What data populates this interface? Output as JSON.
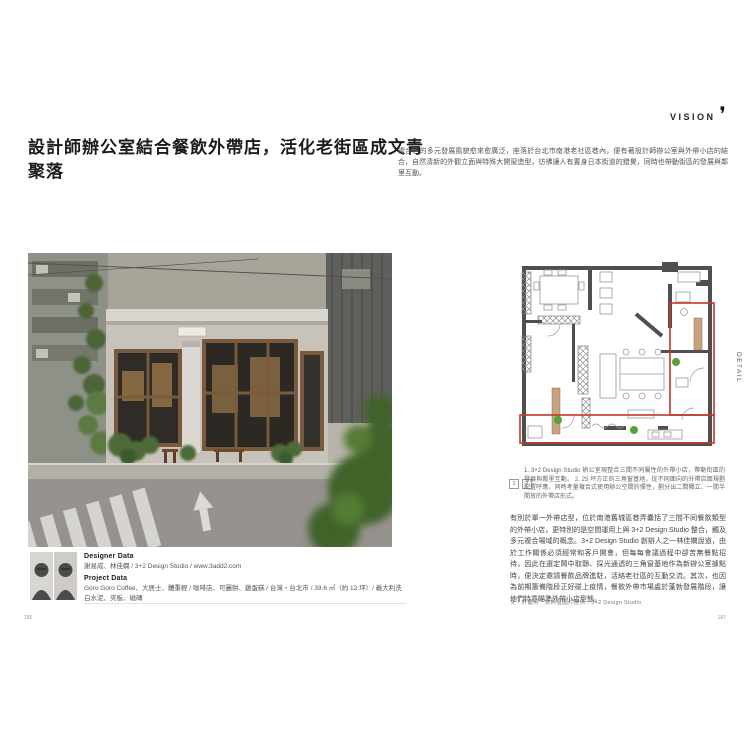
{
  "meta": {
    "page_left": "186",
    "page_right": "187"
  },
  "header": {
    "section_label": "VISION",
    "section_icon": "brush-comma-icon",
    "side_tab_label": "DETAIL"
  },
  "article": {
    "title": "設計師辦公室結合餐飲外帶店，活化老街區成文青聚落",
    "intro": "複合店的多元發展風貌愈來愈廣泛，座落於台北市南港老社區巷內，便有著設計師辦公室與外帶小店的結合，自然清新的外觀立面與特殊大開窗造型，彷彿讓人有置身日本街道的錯覺，同時也帶動街區的發展與鄰里互動。",
    "body": "有別於單一外帶店型，位於南港舊城區巷弄囊括了三間不同餐飲類型的外帶小店，更特別的是空間運用上與 3+2 Design Studio 整合，觸及多元複合場域的概念。3+2 Design Studio 創辦人之一林佳嫻說道，由於工作關係必須經常和客戶開會，但每每會議過程中卻苦無餐點招待，因此在選定鬧中取靜、採光通透的三角窗基地作為新辦公室據點時，便決定邀請餐飲品牌進駐，活絡老社區的互動交流。其次，也因為前期籌備階段正好碰上疫情，餐飲外帶市場處於蓬勃發展階段，讓他們特意瞄準外帶小店型態。",
    "credit": "文｜許嘉芬　資料暨圖片提供｜3+2 Design Studio"
  },
  "captions": {
    "markers": [
      "1",
      "2"
    ],
    "text": "1. 3+2 Design Studio 辦公室現整合三間不同屬性的外帶小店，帶動街區的發展與鄰里互動。 2. 25 坪方正的三角窗基地，從不同面向的外帶店面規劃配置呼應，同時考量複合式使用辦公空間的彈性，劃分出二間獨立、一間半開放的外帶店形式。"
  },
  "data_block": {
    "designer_heading": "Designer Data",
    "designer_text": "謝易成、林佳嫻 / 3+2 Design Studio / www.3add2.com",
    "project_heading": "Project Data",
    "project_text": "Goro Goro Coffee、大居士、體重輕 / 咖啡店、可麗餅、雞蛋糕 / 台灣・台北市 / 39.6 ㎡（約 12 坪）/ 義大利洗白水泥、夾板、磁磚"
  },
  "figures": {
    "photo_name": "cafe-corner-photo",
    "plan_name": "office-floor-plan"
  },
  "colors": {
    "accent_red": "#c0392b",
    "plan_wall": "#4f4f4f",
    "counter_tan": "#c8a380",
    "plant_green": "#57a13b"
  }
}
